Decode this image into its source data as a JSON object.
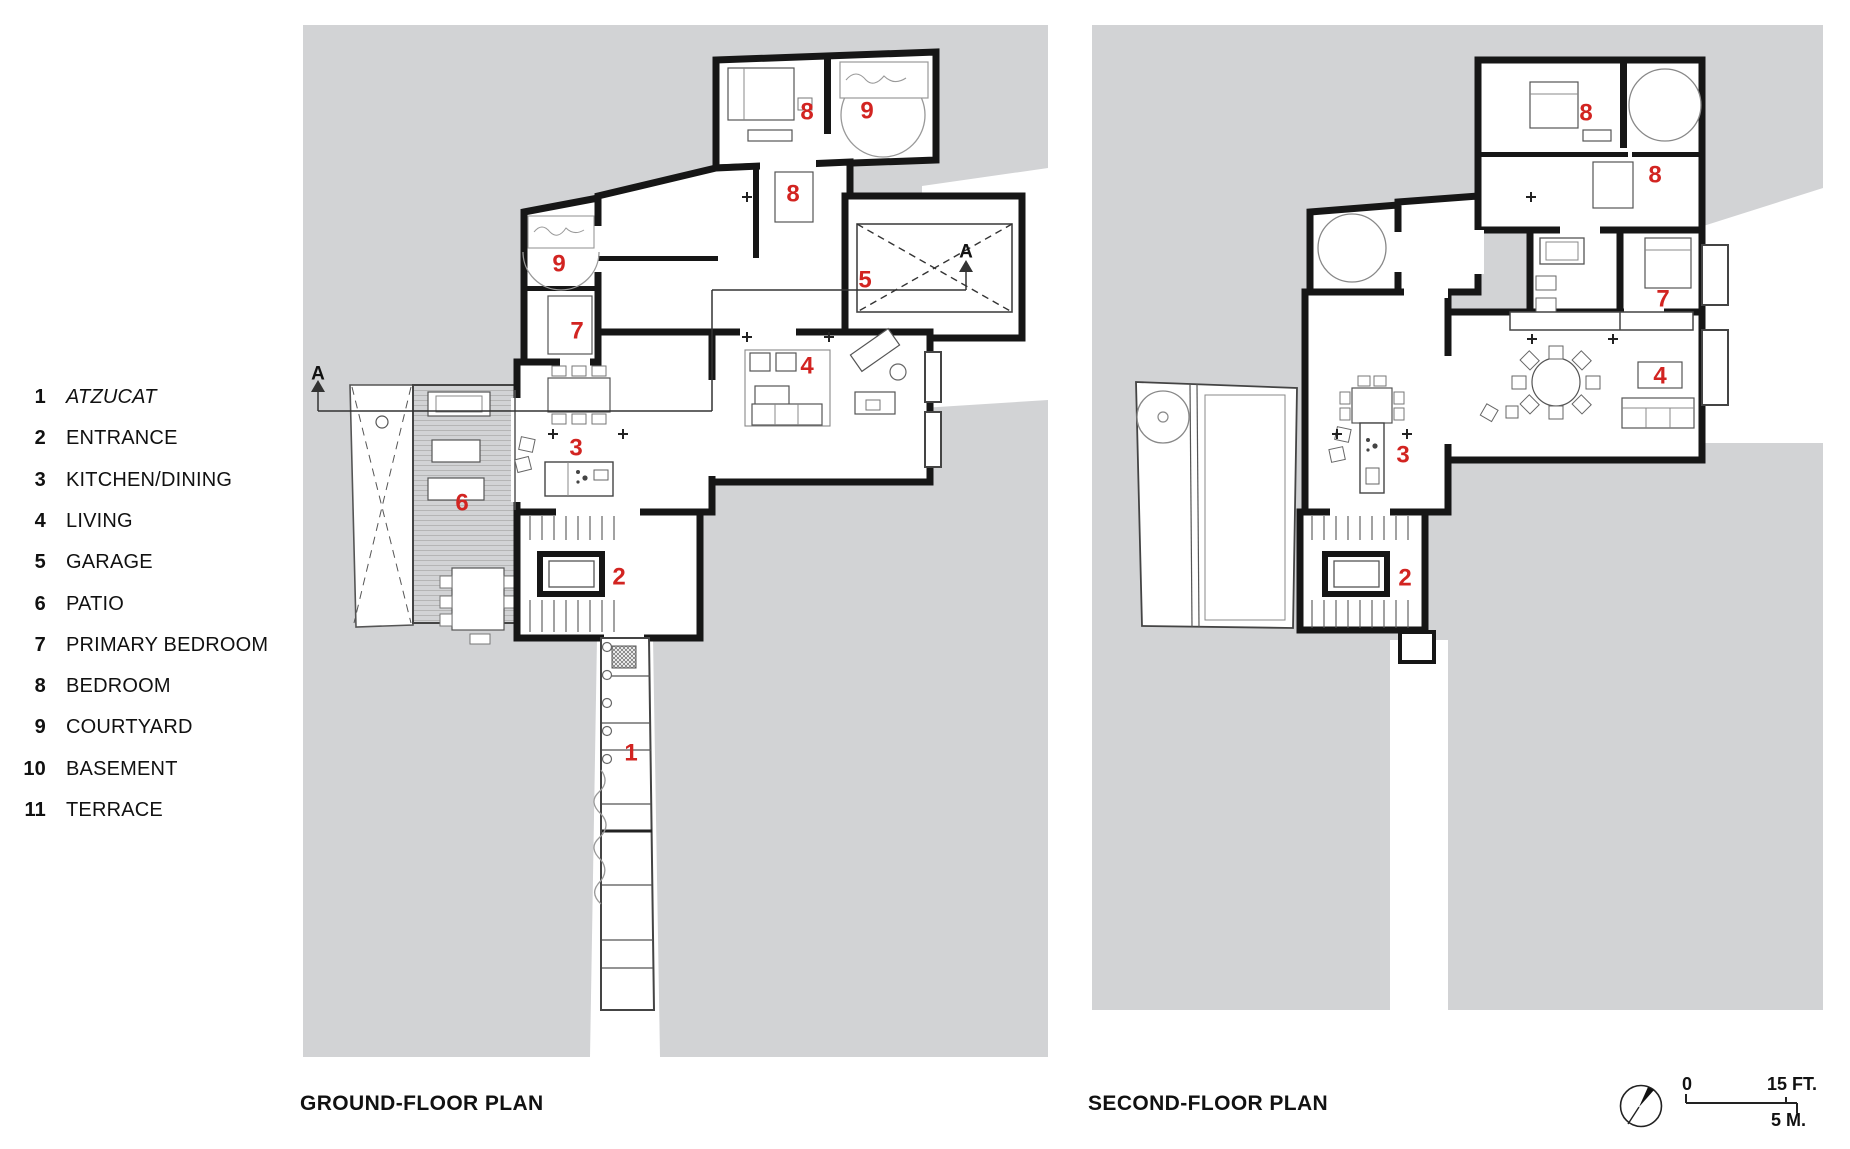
{
  "colors": {
    "site_gray": "#d2d3d5",
    "wall_black": "#161616",
    "accent_red": "#d22421",
    "thin_line": "#4a4a4a"
  },
  "legend": {
    "items": [
      {
        "num": "1",
        "label": "ATZUCAT",
        "italic": true
      },
      {
        "num": "2",
        "label": "ENTRANCE",
        "italic": false
      },
      {
        "num": "3",
        "label": "KITCHEN/DINING",
        "italic": false
      },
      {
        "num": "4",
        "label": "LIVING",
        "italic": false
      },
      {
        "num": "5",
        "label": "GARAGE",
        "italic": false
      },
      {
        "num": "6",
        "label": "PATIO",
        "italic": false
      },
      {
        "num": "7",
        "label": "PRIMARY BEDROOM",
        "italic": false
      },
      {
        "num": "8",
        "label": "BEDROOM",
        "italic": false
      },
      {
        "num": "9",
        "label": "COURTYARD",
        "italic": false
      },
      {
        "num": "10",
        "label": "BASEMENT",
        "italic": false
      },
      {
        "num": "11",
        "label": "TERRACE",
        "italic": false
      }
    ]
  },
  "plans": {
    "ground": {
      "title": "GROUND-FLOOR PLAN",
      "room_labels": [
        {
          "n": "8",
          "x": 807,
          "y": 112
        },
        {
          "n": "9",
          "x": 867,
          "y": 111
        },
        {
          "n": "8",
          "x": 793,
          "y": 194
        },
        {
          "n": "5",
          "x": 865,
          "y": 280
        },
        {
          "n": "9",
          "x": 559,
          "y": 264
        },
        {
          "n": "7",
          "x": 577,
          "y": 331
        },
        {
          "n": "4",
          "x": 807,
          "y": 366
        },
        {
          "n": "3",
          "x": 576,
          "y": 448
        },
        {
          "n": "6",
          "x": 462,
          "y": 503
        },
        {
          "n": "2",
          "x": 619,
          "y": 577
        },
        {
          "n": "1",
          "x": 631,
          "y": 753
        }
      ],
      "section_markers": [
        {
          "letter": "A",
          "x": 318,
          "y": 374
        },
        {
          "letter": "A",
          "x": 966,
          "y": 252
        }
      ]
    },
    "second": {
      "title": "SECOND-FLOOR PLAN",
      "room_labels": [
        {
          "n": "8",
          "x": 1586,
          "y": 113
        },
        {
          "n": "8",
          "x": 1655,
          "y": 175
        },
        {
          "n": "7",
          "x": 1663,
          "y": 299
        },
        {
          "n": "4",
          "x": 1660,
          "y": 376
        },
        {
          "n": "3",
          "x": 1403,
          "y": 455
        },
        {
          "n": "2",
          "x": 1405,
          "y": 578
        }
      ],
      "section_markers": []
    }
  },
  "scale_bar": {
    "zero": "0",
    "imperial": "15 FT.",
    "metric": "5 M.",
    "compass": "north-arrow"
  }
}
